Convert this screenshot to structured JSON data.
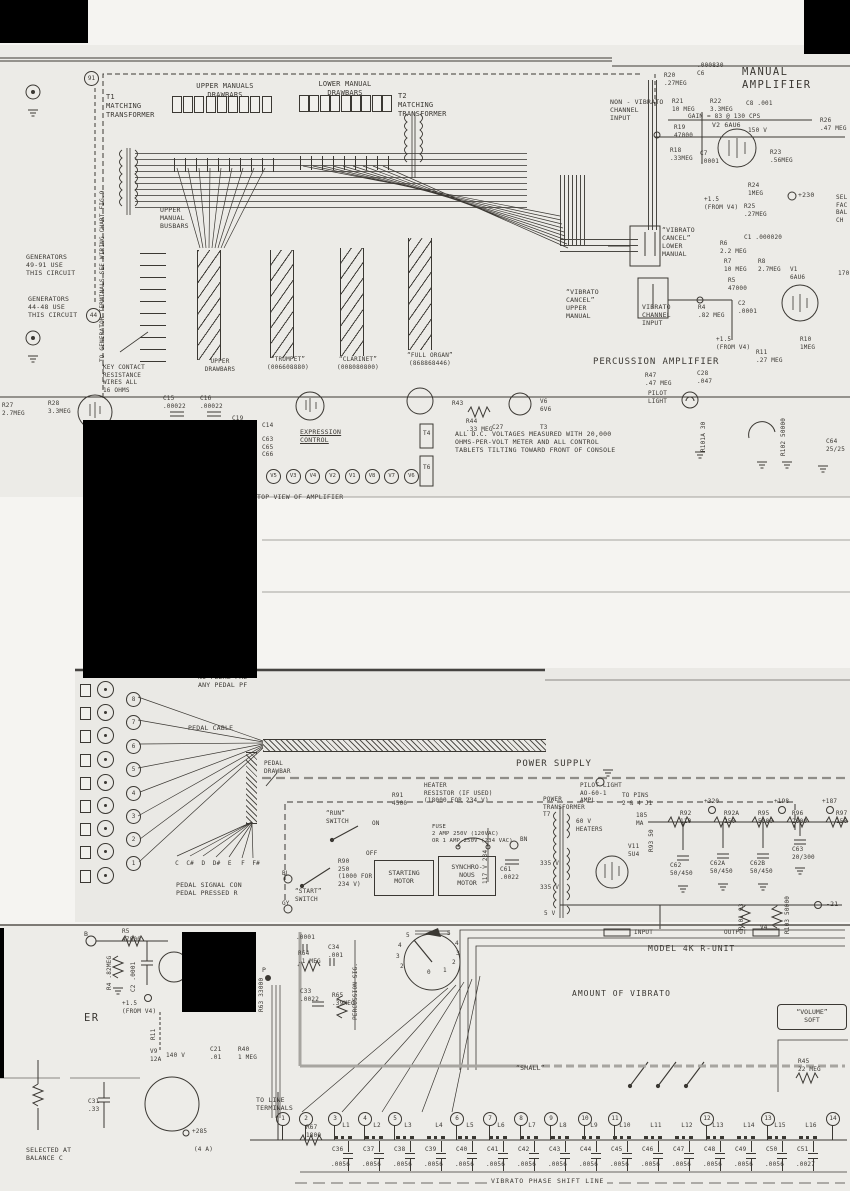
{
  "colors": {
    "paper1": "#ecebe7",
    "paper2": "#eae9e5",
    "paper3": "#edece8",
    "ink": "#3b3833",
    "redact": "#000000",
    "seam": "#56534e",
    "bus_grey": "#a7a5a0"
  },
  "headers": {
    "manual_amplifier": "MANUAL\nAMPLIFIER",
    "percussion_amplifier": "PERCUSSION AMPLIFIER",
    "power_supply": "POWER SUPPLY",
    "model_4k": "MODEL 4K R-UNIT",
    "amount_of_vibrato": "AMOUNT OF VIBRATO",
    "top_view": "TOP VIEW OF AMPLIFIER",
    "dc_note": "ALL D.C. VOLTAGES MEASURED WITH 20,000\nOHMS-PER-VOLT METER AND ALL CONTROL\nTABLETS TILTING TOWARD FRONT OF CONSOLE"
  },
  "labels": {
    "t1": "T1\nMATCHING\nTRANSFORMER",
    "t2": "T2\nMATCHING\nTRANSFORMER",
    "upper_manuals_drawbars": "UPPER MANUALS\nDRAWBARS",
    "lower_manual_drawbars": "LOWER MANUAL\nDRAWBARS",
    "c6": ".000830\nC6",
    "r20": "R20\n.27MEG",
    "r21": "R21\n10 MEG",
    "r22": "R22\n3.3MEG",
    "c8": "C8  .001",
    "gain_note": "GAIN = 83 @ 130 CPS",
    "non_vibrato_input": "NON - VIBRATO\nCHANNEL\nINPUT",
    "r19": "R19\n47000",
    "v2": "V2 6AU6",
    "v2_plate": "150 V",
    "r26": "R26\n.47 MEG",
    "r18": "R18\n.33MEG",
    "c7": "C7\n.0001",
    "r23": "R23\n.56MEG",
    "r24": "R24\n1MEG",
    "plus230": "+230",
    "r25": "R25\n.27MEG",
    "plus15_v2": "+1.5\n(FROM V4)",
    "sel_fac": "SEL\nFAC\nBAL\nCH",
    "gen91_note": "GENERATORS\n49-91 USE\nTHIS CIRCUIT",
    "gen91_term": "91",
    "gen44_note": "GENERATORS\n44-48 USE\nTHIS CIRCUIT",
    "gen44_term": "44",
    "to_generator": "TO GENERATOR TERMINALS\nSEE WIRING CHART FIG.9",
    "upper_manual_busbars": "UPPER\nMANUAL\nBUSBARS",
    "key_contact": "KEY CONTACT\nRESISTANCE\nWIRES ALL\n16 OHMS",
    "upper_drawbars_preset": "UPPER\nDRAWBARS",
    "trumpet_preset": "“TRUMPET”\n(006608880)",
    "clarinet_preset": "“CLARINET”\n(008080800)",
    "full_organ_preset": "“FULL ORGAN”\n(868868446)",
    "vibrato_cancel_lower": "“VIBRATO\nCANCEL”\nLOWER\nMANUAL",
    "vibrato_cancel_upper": "“VIBRATO\nCANCEL”\nUPPER\nMANUAL",
    "vibrato_channel_input": "VIBRATO\nCHANNEL\nINPUT",
    "c1": "C1  .000020",
    "r6": "R6\n2.2 MEG",
    "r7": "R7\n10 MEG",
    "r8": "R8\n2.7MEG",
    "v1": "V1\n6AU6",
    "v1_plate": "170",
    "r5": "R5\n47000",
    "r4": "R4\n.82 MEG",
    "c2": "C2\n.0001",
    "plus15_v1": "+1.5\n(FROM V4)",
    "r10": "R10\n1MEG",
    "r11": "R11\n.27 MEG",
    "r47": "R47\n.47 MEG",
    "c28": "C28\n.047",
    "pilot_light_1": "PILOT\nLIGHT",
    "r27": "R27\n2.7MEG",
    "r28": "R28\n3.3MEG",
    "c15": "C15\n.00022",
    "c16": "C16\n.00022",
    "c19": "C19",
    "c14": "C14",
    "c63_65_66": "C63\nC65\nC66",
    "expression_control": "EXPRESSION\nCONTROL",
    "t4": "T4",
    "t6": "T6",
    "t3": "T3",
    "c27": "C27",
    "r44": "R44\n.33 MEG",
    "r43": "R43",
    "v6_tube": "V6\n6V6",
    "r101a": "R101A  30",
    "r102": "R102  50000",
    "c64": "C64\n25/25",
    "no_pedal": "NO PEDAL PRE\nANY PEDAL PF",
    "pedal_cable": "PEDAL CABLE",
    "pedal_drawbar": "PEDAL\nDRAWBAR",
    "pedal_signal": "PEDAL SIGNAL CON\nPEDAL PRESSED R",
    "r91": "R91\n4500",
    "heater_resistor": "HEATER\nRESISTOR  (IF USED)\n(18000 FOR 234 V)",
    "run_switch": "“RUN”\nSWITCH",
    "on": "ON",
    "off": "OFF",
    "start_switch": "“START”\nSWITCH",
    "r90": "R90\n250\n(1000 FOR\n234 V)",
    "starting_motor": "STARTING\nMOTOR",
    "synchronous_motor": "SYNCHRO-\nNOUS\nMOTOR",
    "fuse": "FUSE\n2 AMP 250V (120VAC)\nOR 1 AMP 250V (234 VAC)",
    "v117": "117 V  234",
    "c61": "C61\n.0022",
    "bn": "BN",
    "bl": "BL",
    "gy": "GY",
    "power_transformer": "POWER\nTRANSFORMER\nT7",
    "pilot_light_2": "PILOT LIGHT\nAO-60-1\nAMPL.",
    "to_pins": "TO PINS\n2 & 4 J1",
    "heaters_60v": "60 V\nHEATERS",
    "ma_185": "185\nMA",
    "r93": "R93  50",
    "v11": "V11\n5U4",
    "w335a": "335 V",
    "w335b": "335 V",
    "w5": "5 V",
    "r92": "R92\n110",
    "r92a": "R92A\n250",
    "r95": "R95\n5000",
    "r96": "R96\n2000",
    "r97": "R97\n150",
    "plus320": "+320",
    "plus198": "+198",
    "plus187": "+187",
    "c62": "C62\n50/450",
    "c62a": "C62A\n50/450",
    "c62b": "C62B\n50/450",
    "c63": "C63\n20/300",
    "minus21": "-21",
    "input": "INPUT",
    "output": "OUTPUT",
    "r101": "R101  93",
    "r103": "R103  50000",
    "v4": "V4",
    "b_term": "B",
    "r5b": "R5\n47000",
    "r4b": "R4 .82MEG",
    "c2b": "C2 .0001",
    "plus15_b": "+1.5\n(FROM V4)",
    "er": "ER",
    "r11b": "R11",
    "v9": "V9\n12A",
    "v140": "140 V",
    "c21": "C21\n.01",
    "r40": "R40\n1 MEG",
    "c31": "C31\n.33",
    "selected_at": "SELECTED AT\nBALANCE C",
    "plus285": "+285",
    "four_a": "(4 A)",
    "p_term": "P",
    "r63": "R63 33000",
    "c_0001": ".0001",
    "r64": "R64\n.1 MEG",
    "c34": "C34\n.001",
    "c33": "C33\n.0022",
    "r65": "R65\n.39MEG",
    "percussion_sig": "PERCUSSION SIG.",
    "small": "“SMALL”",
    "volume_soft": "“VOLUME”\nSOFT",
    "r45": "R45\n22 MEG",
    "to_line_terminals": "TO LINE\nTERMINALS",
    "r67": "R67\n1800"
  },
  "drawbars": {
    "upper": 9,
    "lower": 9
  },
  "amplifier_top": {
    "tubes": [
      "V5",
      "V3",
      "V4",
      "V2",
      "V1",
      "V8",
      "V7",
      "V6"
    ]
  },
  "pedal": {
    "terminals": [
      "8",
      "7",
      "6",
      "5",
      "4",
      "3",
      "2",
      "1"
    ],
    "notes": [
      "C",
      "C#",
      "D",
      "D#",
      "E",
      "F",
      "F#"
    ]
  },
  "rotary": {
    "left": [
      "5",
      "4",
      "3",
      "2"
    ],
    "right": [
      "5",
      "4",
      "3",
      "2",
      "1",
      "0"
    ]
  },
  "phase_line": {
    "title": "VIBRATO PHASE SHIFT LINE",
    "terminals": [
      {
        "n": "1",
        "x": 276
      },
      {
        "n": "2",
        "x": 299
      },
      {
        "n": "3",
        "x": 328
      },
      {
        "n": "4",
        "x": 358
      },
      {
        "n": "5",
        "x": 388
      },
      {
        "n": "6",
        "x": 450
      },
      {
        "n": "7",
        "x": 483
      },
      {
        "n": "8",
        "x": 514
      },
      {
        "n": "9",
        "x": 544
      },
      {
        "n": "10",
        "x": 578
      },
      {
        "n": "11",
        "x": 608
      },
      {
        "n": "12",
        "x": 700
      },
      {
        "n": "13",
        "x": 761
      },
      {
        "n": "14",
        "x": 826
      }
    ],
    "cells": [
      {
        "l": "L1",
        "c": "C36",
        "v": ".0056"
      },
      {
        "l": "L2",
        "c": "C37",
        "v": ".0056"
      },
      {
        "l": "L3",
        "c": "C38",
        "v": ".0056"
      },
      {
        "l": "L4",
        "c": "C39",
        "v": ".0056"
      },
      {
        "l": "L5",
        "c": "C40",
        "v": ".0056"
      },
      {
        "l": "L6",
        "c": "C41",
        "v": ".0056"
      },
      {
        "l": "L7",
        "c": "C42",
        "v": ".0056"
      },
      {
        "l": "L8",
        "c": "C43",
        "v": ".0056"
      },
      {
        "l": "L9",
        "c": "C44",
        "v": ".0056"
      },
      {
        "l": "L10",
        "c": "C45",
        "v": ".0056"
      },
      {
        "l": "L11",
        "c": "C46",
        "v": ".0056"
      },
      {
        "l": "L12",
        "c": "C47",
        "v": ".0056"
      },
      {
        "l": "L13",
        "c": "C48",
        "v": ".0056"
      },
      {
        "l": "L14",
        "c": "C49",
        "v": ".0056"
      },
      {
        "l": "L15",
        "c": "C50",
        "v": ".0056"
      },
      {
        "l": "L16",
        "c": "C51",
        "v": ".0027"
      }
    ]
  }
}
